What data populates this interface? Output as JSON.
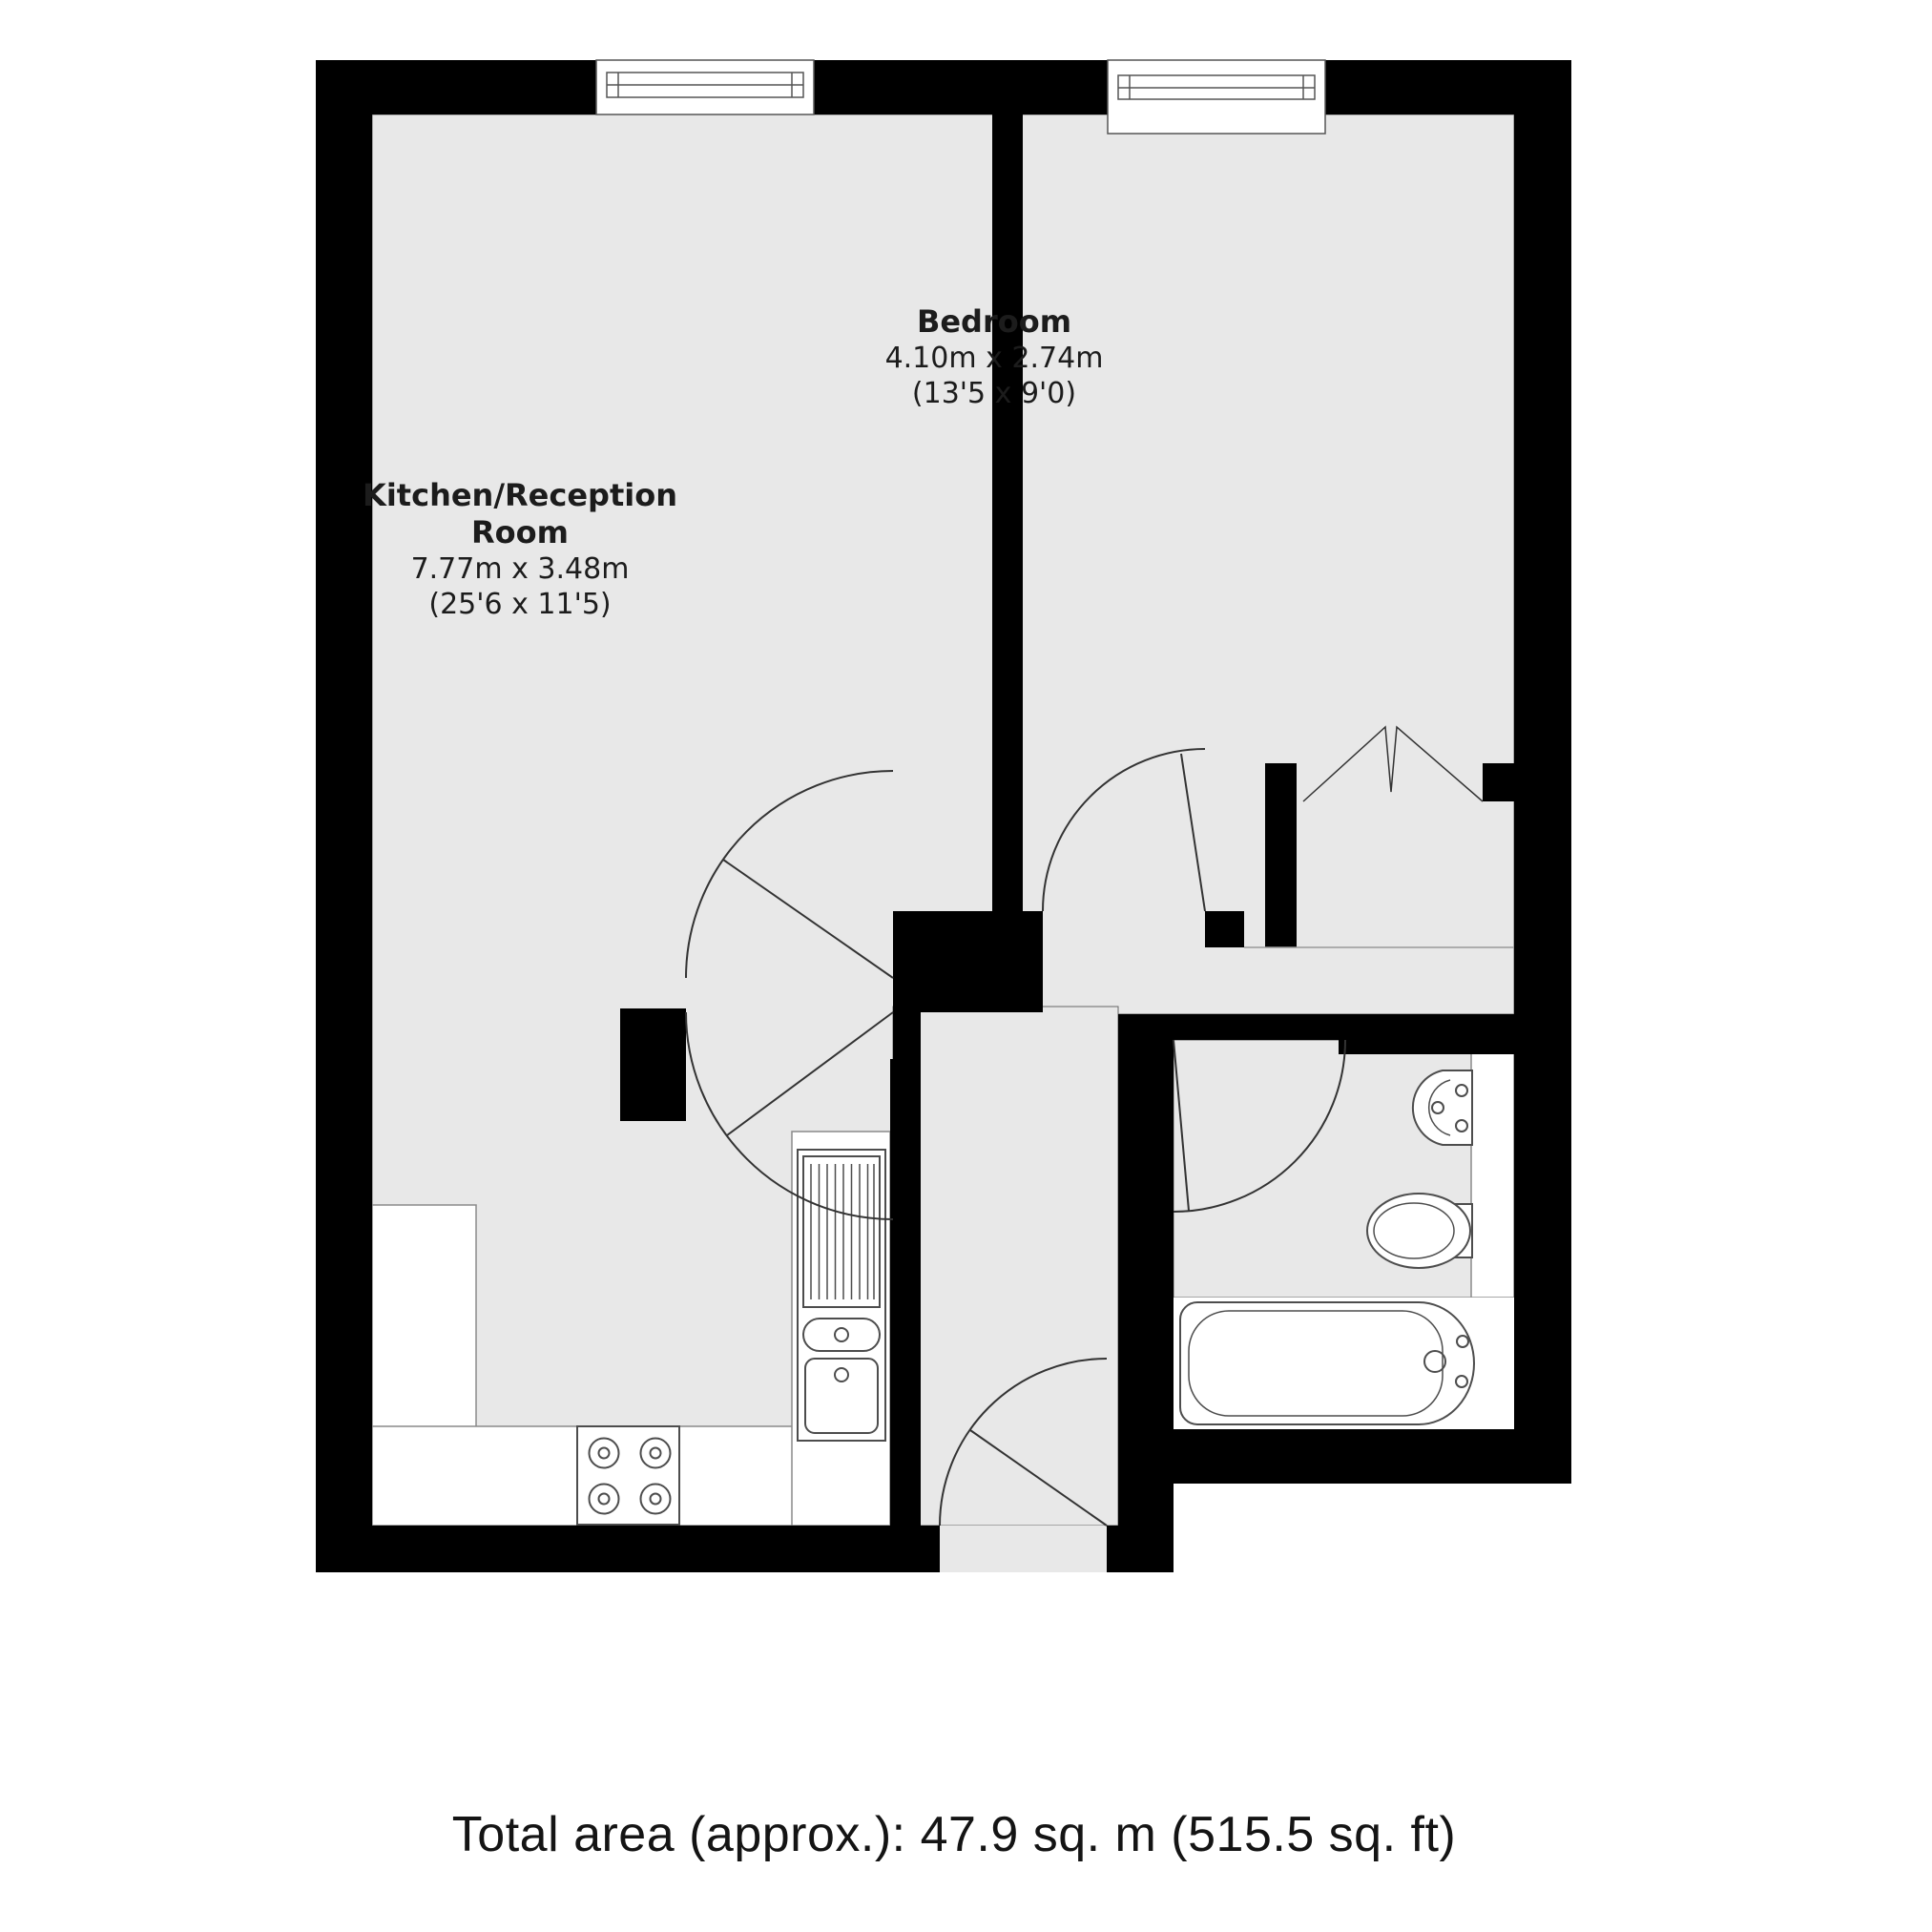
{
  "floorplan": {
    "colors": {
      "wall": "#000000",
      "floor": "#e8e8e8",
      "fixture_line": "#4d4d4d",
      "counter_fill": "#ffffff"
    },
    "rooms": [
      {
        "id": "kitchen_reception",
        "name_line1": "Kitchen/Reception",
        "name_line2": "Room",
        "dimensions_metric": "7.77m x 3.48m",
        "dimensions_imperial": "(25'6 x 11'5)"
      },
      {
        "id": "bedroom",
        "name": "Bedroom",
        "dimensions_metric": "4.10m x 2.74m",
        "dimensions_imperial": "(13'5 x 9'0)"
      }
    ],
    "fixtures": [
      "kitchen-hob",
      "kitchen-sink-drainer",
      "worktop-counters",
      "bathroom-washbasin",
      "toilet",
      "bathtub"
    ],
    "footer": {
      "total_area": "Total area (approx.): 47.9 sq. m (515.5 sq. ft)"
    }
  }
}
